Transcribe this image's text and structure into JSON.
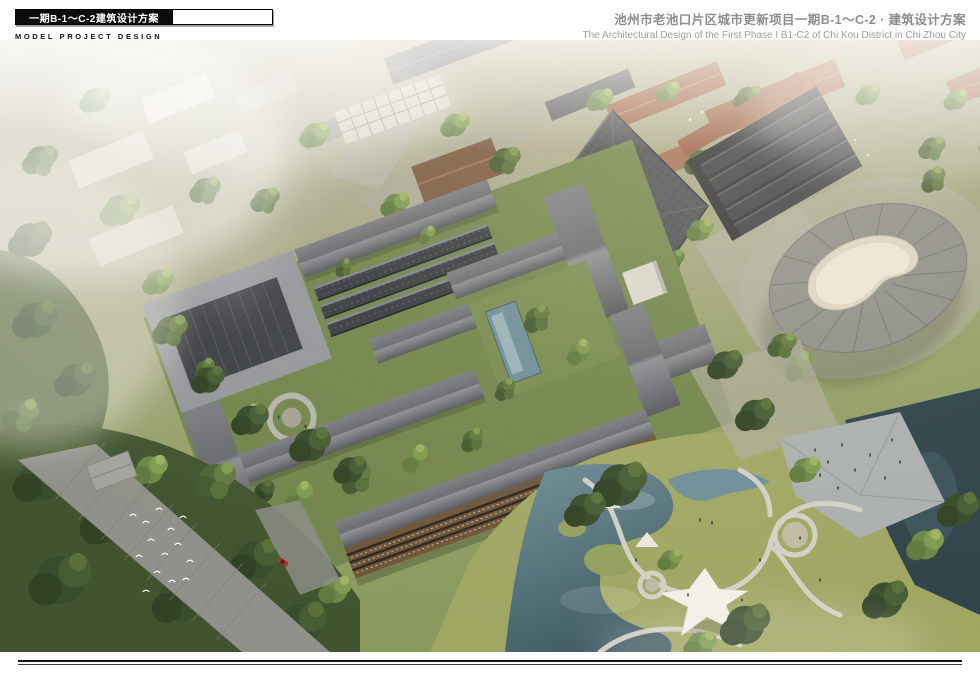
{
  "header": {
    "left": {
      "title": "一期B-1～C-2建筑设计方案",
      "caption": "MODEL PROJECT DESIGN"
    },
    "right": {
      "title": "池州市老池口片区城市更新项目一期B-1～C-2 · 建筑设计方案",
      "subtitle": "The Architectural Design of the First Phase I  B1-C2 of Chi Kou District in Chi Zhou City"
    }
  },
  "rendering": {
    "label": "aerial-perspective-rendering",
    "features": [
      "central-courtyard-hotel-complex",
      "traditional-tiled-gable-roofs",
      "courtyard-trees",
      "reflecting-pool",
      "balcony-guestroom-wing",
      "fan-shaped-heritage-roof",
      "parallel-warehouse-roofs",
      "terracotta-roof-context",
      "radial-roof-cultural-building",
      "rooftop-deck",
      "landscape-park",
      "winding-paths",
      "ponds",
      "tensile-canopy",
      "waterfront-plaza",
      "forest-road",
      "bird-flock",
      "red-car",
      "fog"
    ],
    "colors": {
      "roof_gray": "#6a6b6f",
      "tile_dark": "#3a3c40",
      "terracotta": "#a06449",
      "tree_green": "#5f7a40",
      "lawn_green": "#a0a763",
      "water_teal": "#6f8e98",
      "dark_water": "#2f4349",
      "plaza_gray": "#abb0af",
      "wood": "#6f5638",
      "pale_roof": "#96979b",
      "haze_white": "#f2f0ea"
    }
  }
}
